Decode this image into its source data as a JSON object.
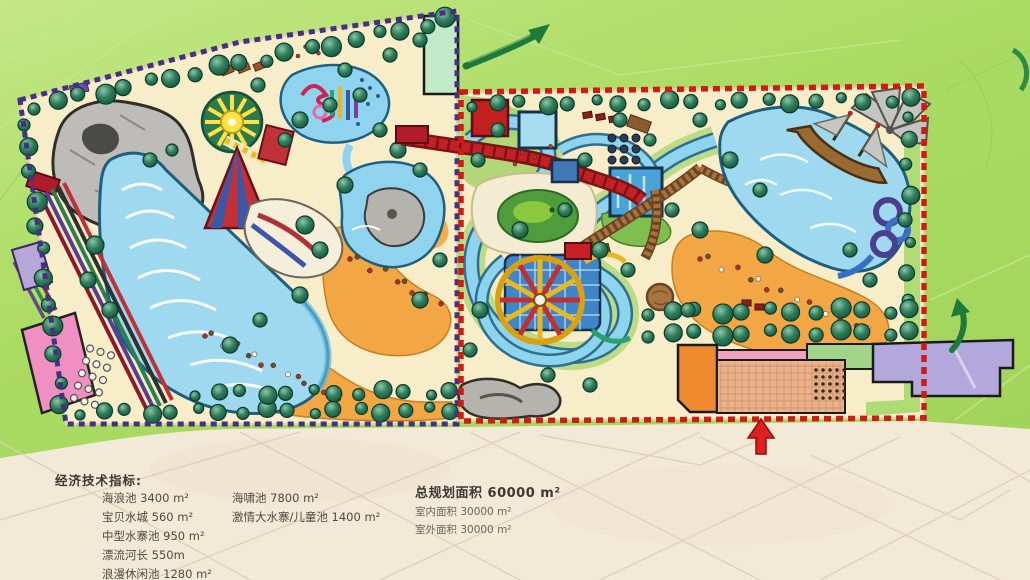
{
  "indicators": {
    "heading": "经济技术指标:",
    "col1": [
      "海浪池 3400 m²",
      "宝贝水城 560 m²",
      "中型水寨池 950 m²",
      "漂流河长 550m",
      "浪漫休闲池 1280 m²"
    ],
    "col2": [
      "海啸池 7800 m²",
      "激情大水寨/儿童池 1400 m²"
    ],
    "col3_title": "总规划面积 60000 m²",
    "col3": [
      "室内面积 30000 m²",
      "室外面积 30000 m²"
    ]
  },
  "palette": {
    "background_green": "#aadb63",
    "paper_beige": "#f2e9d7",
    "parcel_sand": "#f7eec9",
    "water_blue": "#8fd3ef",
    "beach_orange": "#f2a644",
    "tree_green": "#1d6b50",
    "boundary_purple": "#443084",
    "boundary_red": "#d01b15"
  },
  "icons": {
    "flow_arrow_top": "green-curved-arrow",
    "flow_arrow_right": "green-curved-arrow",
    "entrance_arrow": "red-up-arrow"
  }
}
